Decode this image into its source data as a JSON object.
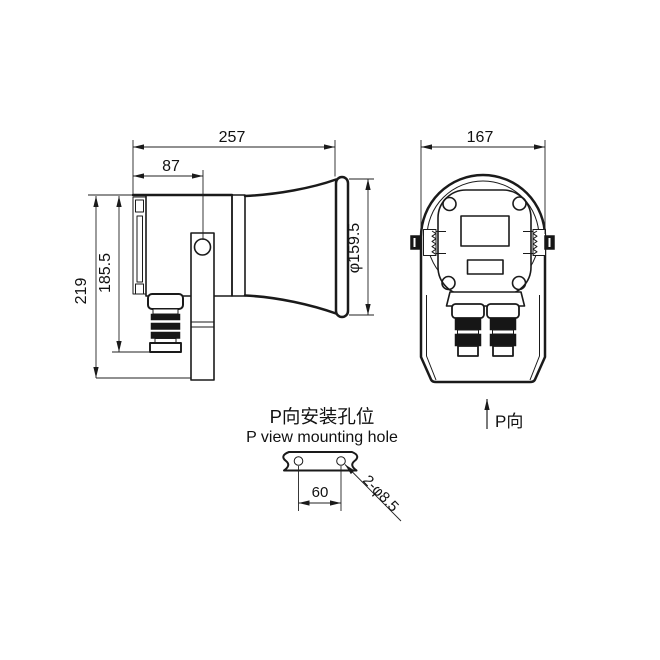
{
  "drawing": {
    "background": "#ffffff",
    "line_color": "#1a1a1a",
    "side_view": {
      "overall_length": "257",
      "bracket_hole_offset": "87",
      "horn_mouth_diameter": "φ159.5",
      "overall_height": "219",
      "height_to_gland_bottom": "185.5"
    },
    "rear_view": {
      "overall_width": "167",
      "view_direction_label": "P向"
    },
    "mounting_detail": {
      "title_cn": "P向安装孔位",
      "title_en": "P view mounting hole",
      "hole_spacing": "60",
      "holes_note": "2-φ8.5"
    }
  }
}
